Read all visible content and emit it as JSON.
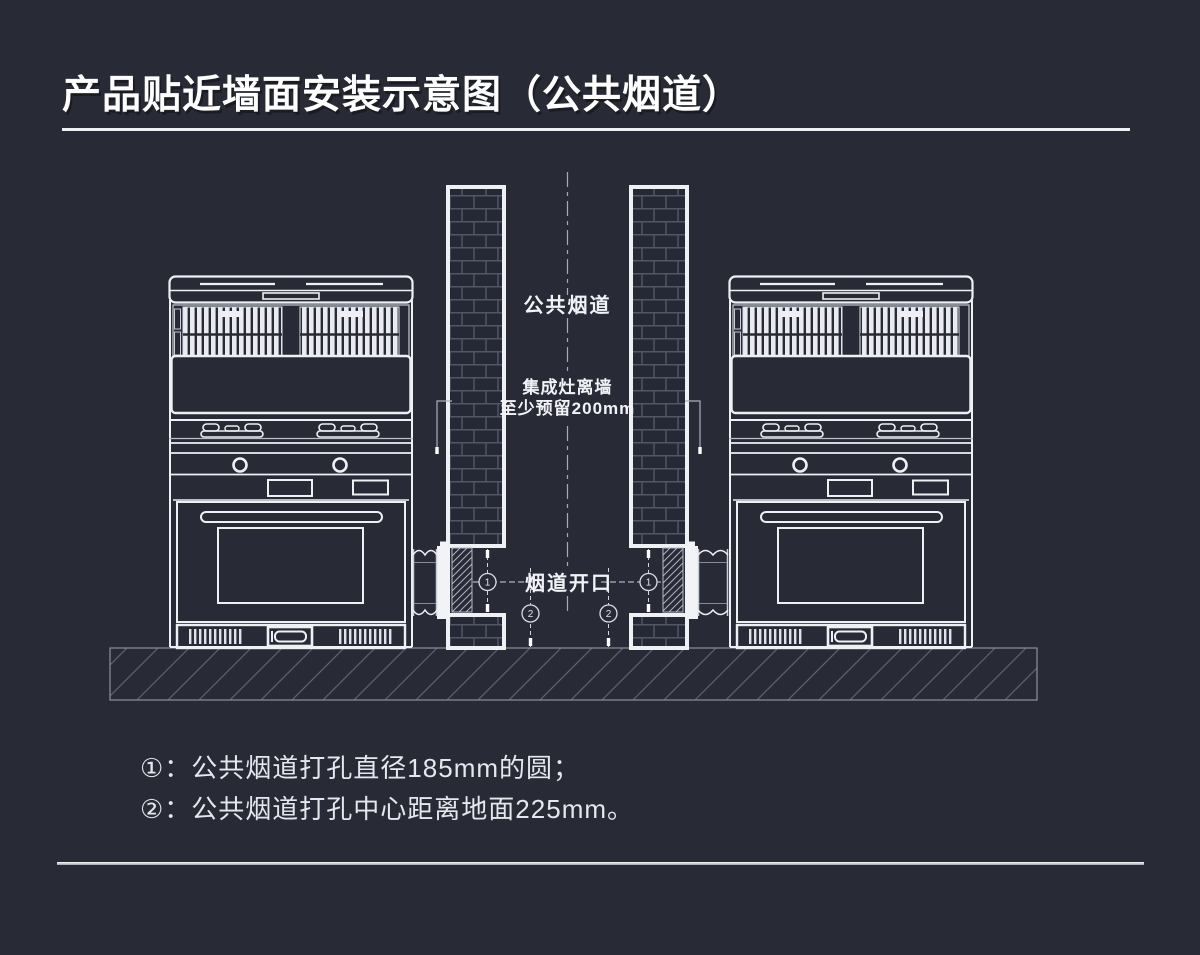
{
  "page": {
    "title": "产品贴近墙面安装示意图（公共烟道）"
  },
  "diagram": {
    "labels": {
      "common_flue": "公共烟道",
      "clearance_line1": "集成灶离墙",
      "clearance_line2": "至少预留200mm",
      "flue_opening": "烟道开口",
      "marker_1": "1",
      "marker_2": "2"
    }
  },
  "notes": {
    "line1": "①：公共烟道打孔直径185mm的圆；",
    "line2": "②：公共烟道打孔中心距离地面225mm。"
  },
  "colors": {
    "background": "#282B36",
    "drawing_line": "#EEF0F4",
    "muted_line": "#9AA0AC",
    "text": "#F2F3F6"
  }
}
